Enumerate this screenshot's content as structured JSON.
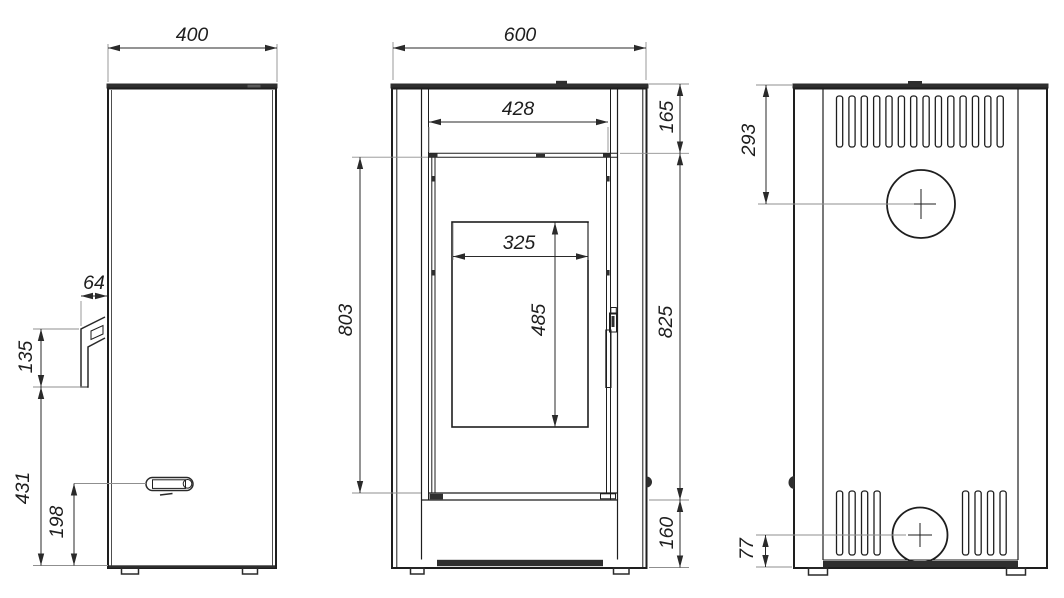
{
  "drawing": {
    "views": {
      "side": {
        "dims": {
          "width": "400",
          "duct_width": "64",
          "duct_height": "135",
          "duct_bottom_offset": "431",
          "handle_height": "198"
        }
      },
      "front": {
        "dims": {
          "width": "600",
          "door_width": "428",
          "top_section_height": "165",
          "glass_width": "325",
          "glass_height": "485",
          "door_height": "803",
          "body_height": "825",
          "base_height": "160"
        }
      },
      "back": {
        "dims": {
          "flue_center_from_top": "293",
          "outlet_center_from_bottom": "77"
        }
      }
    },
    "colors": {
      "line": "#1e1e1e",
      "extension_line": "#8f8f8f",
      "dark_fill": "#2f2f2f",
      "background": "#ffffff"
    }
  }
}
